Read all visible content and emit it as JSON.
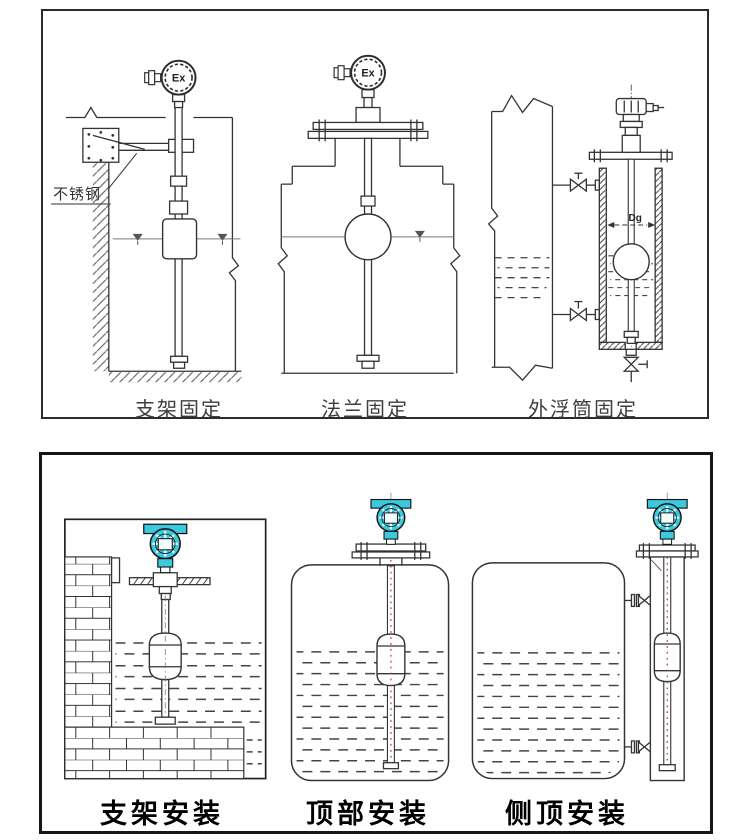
{
  "page": {
    "width": 750,
    "height": 840,
    "background": "#ffffff"
  },
  "colors": {
    "line": "#333333",
    "transmitter_teal": "#3cc9dd",
    "caption_top": "#3d3d3d",
    "caption_bottom": "#000000",
    "centerline_red": "#a3543c"
  },
  "top_panel": {
    "diagrams": [
      {
        "id": "bracket-fixing",
        "caption": "支架固定",
        "annotation": "不锈钢",
        "head_label": "Ex"
      },
      {
        "id": "flange-fixing",
        "caption": "法兰固定",
        "head_label": "Ex"
      },
      {
        "id": "external-chamber-fixing",
        "caption": "外浮筒固定",
        "dimension_label": "Dg"
      }
    ]
  },
  "bottom_panel": {
    "diagrams": [
      {
        "id": "bracket-mounting",
        "caption": "支架安装"
      },
      {
        "id": "top-mounting",
        "caption": "顶部安装"
      },
      {
        "id": "side-top-mounting",
        "caption": "侧顶安装"
      }
    ]
  }
}
